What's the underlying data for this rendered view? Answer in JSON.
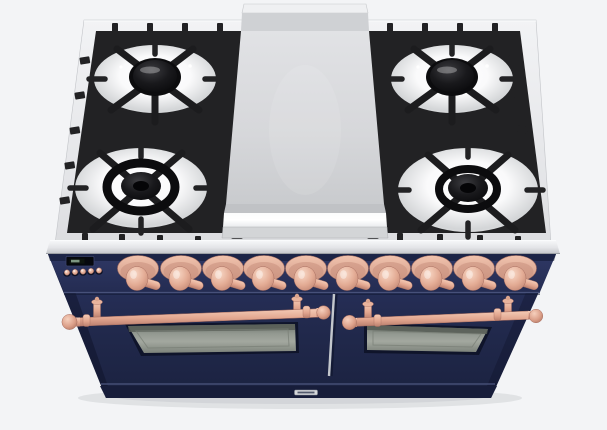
{
  "image": {
    "alt": "Freestanding dual-fuel range viewed from the front-top: stainless cooktop with four gas burners on black cast-iron grates, a center stainless griddle plate, midnight navy blue body with copper knobs, copper towel-bar oven handles and two oven doors"
  },
  "colors": {
    "bg": "#f3f4f6",
    "stainless_light": "#f0f1f3",
    "stainless": "#dfe0e3",
    "stainless_dark": "#c6c8cc",
    "grate": "#222224",
    "burner_black": "#0c0c0e",
    "bowl_white": "#ffffff",
    "griddle": "#d7d8db",
    "navy": "#222a4e",
    "navy_dark": "#1b2240",
    "navy_panel": "#273056",
    "groove": "#47517a",
    "copper": "#e2a68f",
    "copper_light": "#f3c9b4",
    "copper_dark": "#bd8271",
    "window_glass": "#949a92",
    "badge": "#d5d7da"
  },
  "cooktop": {
    "gas_burners": 4,
    "grate_sections": 2,
    "griddle_present": true
  },
  "control_panel": {
    "knobs": 10,
    "small_buttons": 5,
    "has_display": true,
    "display_text": ""
  },
  "oven": {
    "doors": 2,
    "towel_bar_handles": 2,
    "windows": 2
  },
  "branding": {
    "badge_visible": true,
    "badge_text": ""
  }
}
